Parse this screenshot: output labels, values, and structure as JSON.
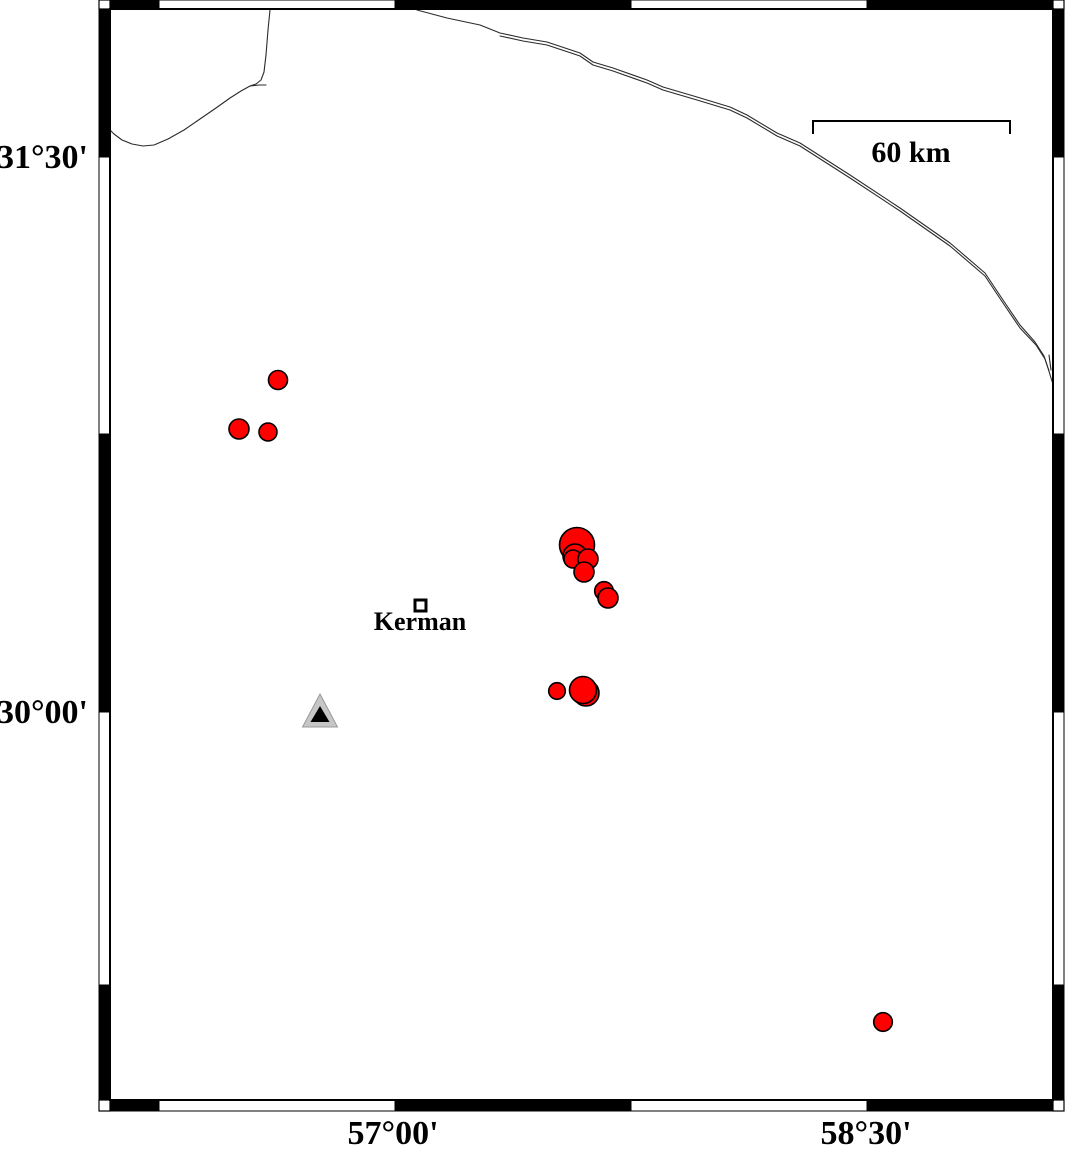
{
  "figure": {
    "type": "seismicity-map",
    "background": "#ffffff",
    "ink": "#000000"
  },
  "frame": {
    "inner": {
      "x": 110,
      "y": 9,
      "width": 943,
      "height": 1091
    },
    "band_thickness": 11,
    "top_segments": [
      {
        "start": 110,
        "end": 159,
        "fill": "#000000"
      },
      {
        "start": 159,
        "end": 395,
        "fill": "#ffffff"
      },
      {
        "start": 395,
        "end": 631,
        "fill": "#000000"
      },
      {
        "start": 631,
        "end": 867,
        "fill": "#ffffff"
      },
      {
        "start": 867,
        "end": 1053,
        "fill": "#000000"
      }
    ],
    "bottom_segments": [
      {
        "start": 110,
        "end": 159,
        "fill": "#000000"
      },
      {
        "start": 159,
        "end": 395,
        "fill": "#ffffff"
      },
      {
        "start": 395,
        "end": 631,
        "fill": "#000000"
      },
      {
        "start": 631,
        "end": 867,
        "fill": "#ffffff"
      },
      {
        "start": 867,
        "end": 1053,
        "fill": "#000000"
      }
    ],
    "left_segments": [
      {
        "start": 9,
        "end": 157,
        "fill": "#000000"
      },
      {
        "start": 157,
        "end": 434,
        "fill": "#ffffff"
      },
      {
        "start": 434,
        "end": 712,
        "fill": "#000000"
      },
      {
        "start": 712,
        "end": 985,
        "fill": "#ffffff"
      },
      {
        "start": 985,
        "end": 1100,
        "fill": "#000000"
      }
    ],
    "right_segments": [
      {
        "start": 9,
        "end": 157,
        "fill": "#000000"
      },
      {
        "start": 157,
        "end": 434,
        "fill": "#ffffff"
      },
      {
        "start": 434,
        "end": 712,
        "fill": "#000000"
      },
      {
        "start": 712,
        "end": 985,
        "fill": "#ffffff"
      },
      {
        "start": 985,
        "end": 1100,
        "fill": "#000000"
      }
    ]
  },
  "axis_labels": {
    "left": [
      {
        "text": "31°30'",
        "y": 157
      },
      {
        "text": "30°00'",
        "y": 712
      }
    ],
    "bottom": [
      {
        "text": "57°00'",
        "x": 393
      },
      {
        "text": "58°30'",
        "x": 866
      }
    ]
  },
  "scale_bar": {
    "label": "60 km",
    "x1": 813,
    "x2": 1010,
    "y": 121,
    "tick_drop": 13,
    "label_x": 911,
    "label_y": 162
  },
  "city": {
    "label": "Kerman",
    "x": 415,
    "y": 600,
    "size": 11,
    "label_x": 420,
    "label_y": 630
  },
  "station": {
    "outer_points": "320,694 302.5,727 337.5,727",
    "inner_points": "320,706 310.5,722 329.5,722",
    "outer_fill": "#c6c6c6",
    "outer_stroke": "#9a9a9a",
    "inner_fill": "#000000"
  },
  "earthquakes": {
    "fill": "#ff0000",
    "stroke": "#000000",
    "points": [
      {
        "x": 278,
        "y": 380,
        "r": 9.5
      },
      {
        "x": 239,
        "y": 429,
        "r": 10
      },
      {
        "x": 268,
        "y": 432,
        "r": 9
      },
      {
        "x": 577,
        "y": 545,
        "r": 17.5
      },
      {
        "x": 575,
        "y": 556,
        "r": 12
      },
      {
        "x": 573,
        "y": 559,
        "r": 9
      },
      {
        "x": 588,
        "y": 559,
        "r": 10
      },
      {
        "x": 584,
        "y": 572,
        "r": 10
      },
      {
        "x": 604,
        "y": 591,
        "r": 9.3
      },
      {
        "x": 608,
        "y": 598,
        "r": 10
      },
      {
        "x": 586,
        "y": 693,
        "r": 13
      },
      {
        "x": 583,
        "y": 690,
        "r": 13.5
      },
      {
        "x": 557,
        "y": 691,
        "r": 8.3
      },
      {
        "x": 883,
        "y": 1022,
        "r": 9.3
      }
    ]
  },
  "rivers": {
    "stroke": "#2b2b2b",
    "paths": [
      {
        "name": "west-stream",
        "points": [
          [
            270,
            10
          ],
          [
            268,
            30
          ],
          [
            266,
            55
          ],
          [
            264,
            72
          ],
          [
            261,
            80
          ],
          [
            256,
            84
          ],
          [
            250,
            86
          ],
          [
            241,
            91
          ],
          [
            230,
            98
          ],
          [
            216,
            108
          ],
          [
            200,
            119
          ],
          [
            184,
            130
          ],
          [
            168,
            139
          ],
          [
            154,
            145
          ],
          [
            143,
            146
          ],
          [
            132,
            144
          ],
          [
            122,
            140
          ],
          [
            114,
            134
          ],
          [
            110,
            130
          ]
        ]
      },
      {
        "name": "west-stream-spur",
        "points": [
          [
            250,
            86
          ],
          [
            259,
            85
          ],
          [
            266,
            85
          ]
        ]
      },
      {
        "name": "east-stream",
        "points": [
          [
            417,
            10
          ],
          [
            447,
            18
          ],
          [
            480,
            25
          ],
          [
            500,
            33
          ],
          [
            523,
            38
          ],
          [
            547,
            42
          ],
          [
            580,
            53
          ],
          [
            593,
            62
          ],
          [
            613,
            68
          ],
          [
            647,
            80
          ],
          [
            663,
            87
          ],
          [
            697,
            97
          ],
          [
            730,
            107
          ],
          [
            747,
            115
          ],
          [
            777,
            133
          ],
          [
            800,
            143
          ],
          [
            850,
            175
          ],
          [
            900,
            208
          ],
          [
            950,
            243
          ],
          [
            985,
            273
          ],
          [
            1003,
            300
          ],
          [
            1020,
            325
          ],
          [
            1035,
            342
          ],
          [
            1044,
            356
          ],
          [
            1048,
            368
          ],
          [
            1051,
            378
          ],
          [
            1053,
            384
          ]
        ]
      },
      {
        "name": "east-stream-twin",
        "points": [
          [
            500,
            36
          ],
          [
            523,
            41
          ],
          [
            547,
            45
          ],
          [
            580,
            56
          ],
          [
            593,
            65
          ],
          [
            613,
            71
          ],
          [
            647,
            83
          ],
          [
            663,
            90
          ],
          [
            697,
            100
          ],
          [
            730,
            110
          ],
          [
            747,
            118
          ],
          [
            777,
            136
          ],
          [
            800,
            146
          ],
          [
            850,
            178
          ],
          [
            900,
            211
          ],
          [
            950,
            246
          ],
          [
            985,
            276
          ],
          [
            1003,
            303
          ],
          [
            1020,
            328
          ],
          [
            1036,
            345
          ],
          [
            1045,
            359
          ],
          [
            1049,
            371
          ]
        ]
      },
      {
        "name": "east-stream-spur",
        "points": [
          [
            1049,
            355
          ],
          [
            1051,
            370
          ]
        ]
      }
    ]
  }
}
